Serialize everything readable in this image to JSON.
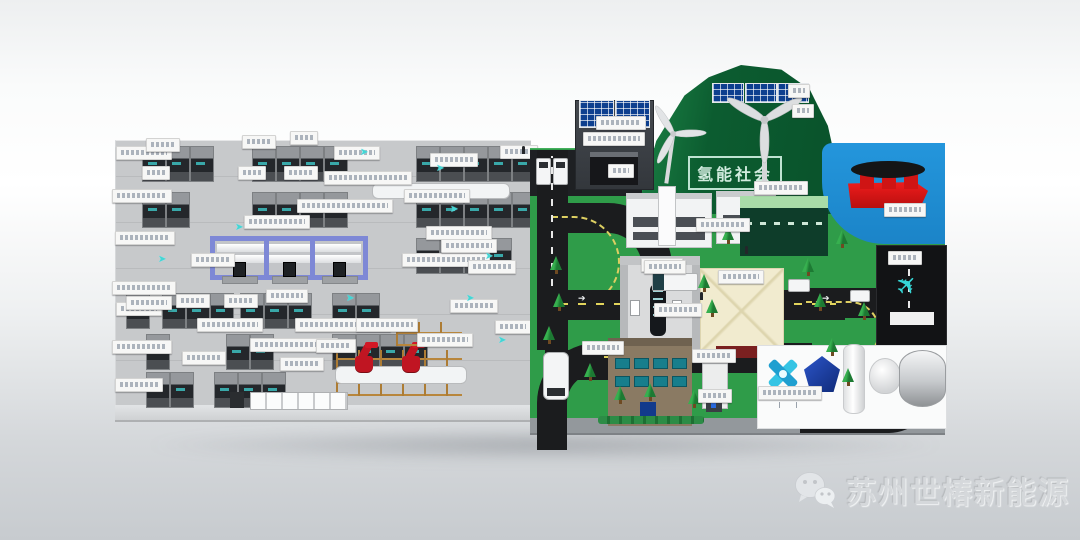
{
  "texts": {
    "mountain_sign": "氢能社会",
    "watermark": "苏州世椿新能源"
  },
  "icons": {
    "flow_arrow_glyph": "➤",
    "road_arrow_glyph": "➔",
    "airplane_glyph": "✈",
    "wechat_icon": "wechat-bubbles"
  },
  "colors": {
    "factory_floor": "#c7c9cb",
    "machine_dark": "#24272b",
    "gantry_blue": "#7e88d6",
    "robot_red": "#c01522",
    "grass_green": "#2f9c49",
    "mountain_green": "#0c5c30",
    "water_blue": "#2496dc",
    "road_black": "#1b1c1e",
    "ship_red": "#ee1c1c",
    "accent_cyan": "#35d6d6",
    "solar_blue": "#0d3f8f",
    "plaza_cream": "#f1ebcf",
    "school_brown": "#8a7a63",
    "watermark_gray": "#d5d8db"
  },
  "note": "small white equipment labels in source are below legibility; rendered as blank label chips",
  "factory": {
    "machine_rows": [
      {
        "y": 146,
        "xs": [
          142,
          166,
          190,
          252,
          276,
          300,
          324,
          416,
          440,
          464,
          488,
          512
        ]
      },
      {
        "y": 192,
        "xs": [
          142,
          166,
          252,
          276,
          300,
          324,
          416,
          440,
          464,
          488,
          512
        ]
      },
      {
        "y": 238,
        "xs": [
          416,
          440,
          464,
          488
        ]
      },
      {
        "y": 293,
        "xs": [
          126,
          162,
          186,
          210,
          240,
          264,
          288,
          332,
          356
        ]
      },
      {
        "y": 334,
        "xs": [
          146,
          226,
          250,
          332,
          356,
          380,
          404
        ]
      },
      {
        "y": 372,
        "xs": [
          146,
          170,
          214,
          238,
          262
        ]
      }
    ],
    "labels": [
      [
        116,
        146,
        54
      ],
      [
        112,
        189,
        58
      ],
      [
        115,
        231,
        58
      ],
      [
        112,
        281,
        62
      ],
      [
        116,
        302,
        44
      ],
      [
        112,
        340,
        58
      ],
      [
        115,
        378,
        46
      ],
      [
        146,
        138,
        32
      ],
      [
        242,
        135,
        32
      ],
      [
        290,
        131,
        26
      ],
      [
        334,
        146,
        44
      ],
      [
        430,
        153,
        46
      ],
      [
        500,
        145,
        36
      ],
      [
        142,
        166,
        26
      ],
      [
        238,
        166,
        26
      ],
      [
        284,
        166,
        32
      ],
      [
        324,
        171,
        86
      ],
      [
        404,
        189,
        64
      ],
      [
        297,
        199,
        94
      ],
      [
        244,
        215,
        64
      ],
      [
        191,
        253,
        42
      ],
      [
        402,
        253,
        86
      ],
      [
        126,
        296,
        44
      ],
      [
        176,
        294,
        32
      ],
      [
        224,
        294,
        32
      ],
      [
        266,
        289,
        40
      ],
      [
        197,
        318,
        64
      ],
      [
        295,
        318,
        94
      ],
      [
        250,
        338,
        86
      ],
      [
        182,
        351,
        42
      ],
      [
        417,
        333,
        54
      ],
      [
        426,
        226,
        64
      ],
      [
        441,
        239,
        54
      ],
      [
        468,
        260,
        46
      ],
      [
        450,
        299,
        46
      ],
      [
        495,
        320,
        34
      ],
      [
        280,
        357,
        42
      ],
      [
        316,
        339,
        38
      ],
      [
        356,
        318,
        60
      ]
    ],
    "arrows": [
      [
        360,
        148
      ],
      [
        436,
        164
      ],
      [
        450,
        205
      ],
      [
        485,
        252
      ],
      [
        346,
        294
      ],
      [
        466,
        294
      ],
      [
        498,
        336
      ],
      [
        158,
        255
      ],
      [
        235,
        223
      ]
    ]
  },
  "park": {
    "labels": [
      [
        596,
        116,
        48
      ],
      [
        608,
        164,
        24
      ],
      [
        641,
        258,
        40
      ],
      [
        696,
        218,
        52
      ],
      [
        754,
        181,
        52
      ],
      [
        788,
        84,
        20
      ],
      [
        792,
        104,
        20
      ],
      [
        884,
        203,
        40
      ],
      [
        888,
        251,
        32
      ],
      [
        718,
        270,
        44
      ],
      [
        644,
        260,
        40
      ],
      [
        758,
        386,
        62
      ],
      [
        692,
        349,
        42
      ],
      [
        582,
        341,
        40
      ],
      [
        654,
        303,
        46
      ],
      [
        698,
        389,
        32
      ]
    ],
    "trees": [
      [
        550,
        256
      ],
      [
        553,
        293
      ],
      [
        543,
        326
      ],
      [
        584,
        363
      ],
      [
        614,
        386
      ],
      [
        698,
        274
      ],
      [
        706,
        299
      ],
      [
        722,
        226
      ],
      [
        802,
        258
      ],
      [
        814,
        293
      ],
      [
        826,
        338
      ],
      [
        842,
        368
      ],
      [
        858,
        302
      ],
      [
        836,
        230
      ],
      [
        644,
        383
      ],
      [
        688,
        390
      ]
    ],
    "road_arrows": [
      [
        578,
        294,
        0
      ],
      [
        700,
        294,
        0
      ],
      [
        822,
        294,
        0
      ],
      [
        640,
        348,
        180
      ],
      [
        770,
        348,
        180
      ],
      [
        906,
        300,
        270
      ]
    ]
  }
}
